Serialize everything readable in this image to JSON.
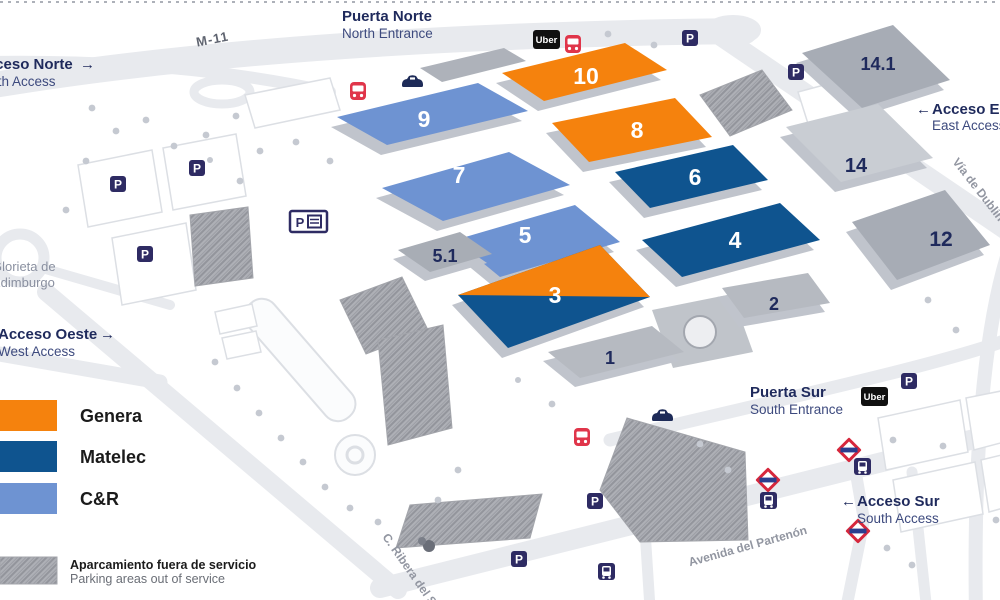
{
  "entrances": {
    "north": {
      "title": "Puerta Norte",
      "subtitle": "North Entrance"
    },
    "south": {
      "title": "Puerta Sur",
      "subtitle": "South Entrance"
    }
  },
  "accesses": {
    "north": {
      "title": "Acceso Norte",
      "subtitle": "North Access",
      "arrow": "→"
    },
    "east": {
      "title": "Acceso Este",
      "subtitle": "East Access",
      "arrow": "←"
    },
    "west": {
      "title": "Acceso Oeste",
      "subtitle": "West Access",
      "arrow": "→"
    },
    "south": {
      "title": "Acceso Sur",
      "subtitle": "South Access",
      "arrow": "←"
    }
  },
  "streets": {
    "m11": "M-11",
    "via_dublin": "Vía de Dublín",
    "avenida_partenon": "Avenida del Partenón",
    "ribera_sena": "C. Ribera del Sena",
    "glorieta_l1": "Glorieta de",
    "glorieta_l2": "Edimburgo"
  },
  "halls": [
    {
      "label": "10",
      "event": "Genera"
    },
    {
      "label": "8",
      "event": "Genera"
    },
    {
      "label": "3",
      "event": "Genera / Matelec"
    },
    {
      "label": "6",
      "event": "Matelec"
    },
    {
      "label": "4",
      "event": "Matelec"
    },
    {
      "label": "9",
      "event": "C&R"
    },
    {
      "label": "7",
      "event": "C&R"
    },
    {
      "label": "5",
      "event": "C&R"
    },
    {
      "label": "5.1",
      "event": ""
    },
    {
      "label": "2",
      "event": ""
    },
    {
      "label": "1",
      "event": ""
    },
    {
      "label": "14.1",
      "event": ""
    },
    {
      "label": "14",
      "event": ""
    },
    {
      "label": "12",
      "event": ""
    }
  ],
  "legend": {
    "items": [
      {
        "label": "Genera",
        "color": "#F5820D"
      },
      {
        "label": "Matelec",
        "color": "#0F548F"
      },
      {
        "label": "C&R",
        "color": "#6E93D2"
      }
    ],
    "parking_note_es": "Aparcamiento fuera de servicio",
    "parking_note_en": "Parking areas out of service"
  },
  "icons": {
    "uber": "Uber",
    "parking": "P"
  },
  "colors": {
    "genera": "#F5820D",
    "matelec": "#0F548F",
    "cr": "#6E93D2",
    "navy_text": "#1F2A5C",
    "badge": "#2E2B63",
    "bus_red": "#E0354A",
    "road": "#E8EAEE"
  }
}
